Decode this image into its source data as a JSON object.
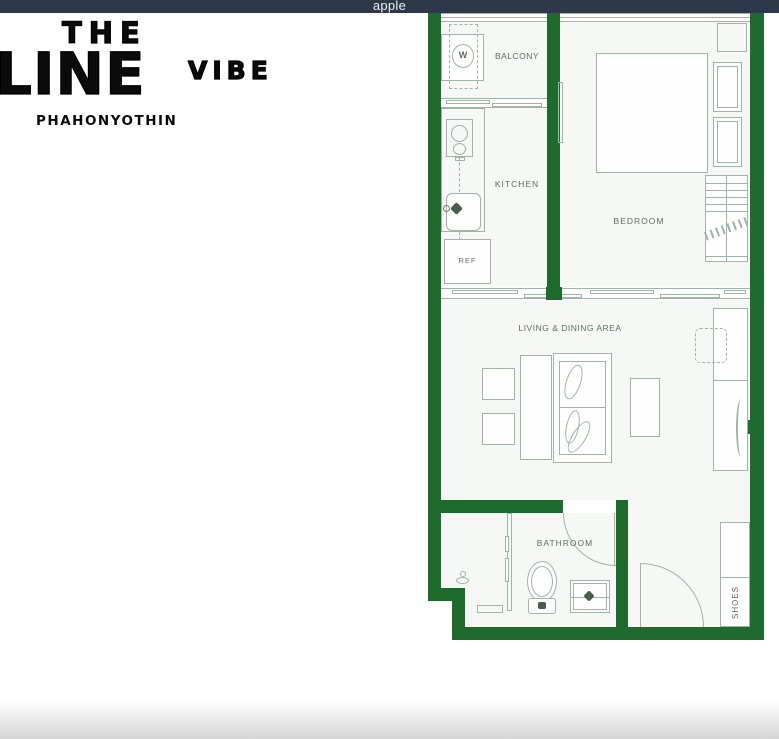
{
  "top_bar": {
    "title": "apple",
    "bg_color": "#2d3948",
    "text_color": "#e9edf2"
  },
  "logo": {
    "word_the": "THE",
    "word_line": "LINE",
    "word_vibe": "VIBE",
    "subtitle": "PHAHONYOTHIN",
    "color": "#0b0b0b"
  },
  "floor_plan": {
    "colors": {
      "wall": "#1f6b2e",
      "lines": "#a0b5a5",
      "labels": "#5d6f61",
      "room_background": "#f5f8f5"
    },
    "rooms": {
      "balcony": "BALCONY",
      "kitchen": "KITCHEN",
      "bedroom": "BEDROOM",
      "living_dining": "LIVING & DINING AREA",
      "bathroom": "BATHROOM"
    },
    "fixtures": {
      "washer": "W",
      "refrigerator": "REF",
      "shoe_cabinet": "SHOES"
    }
  }
}
